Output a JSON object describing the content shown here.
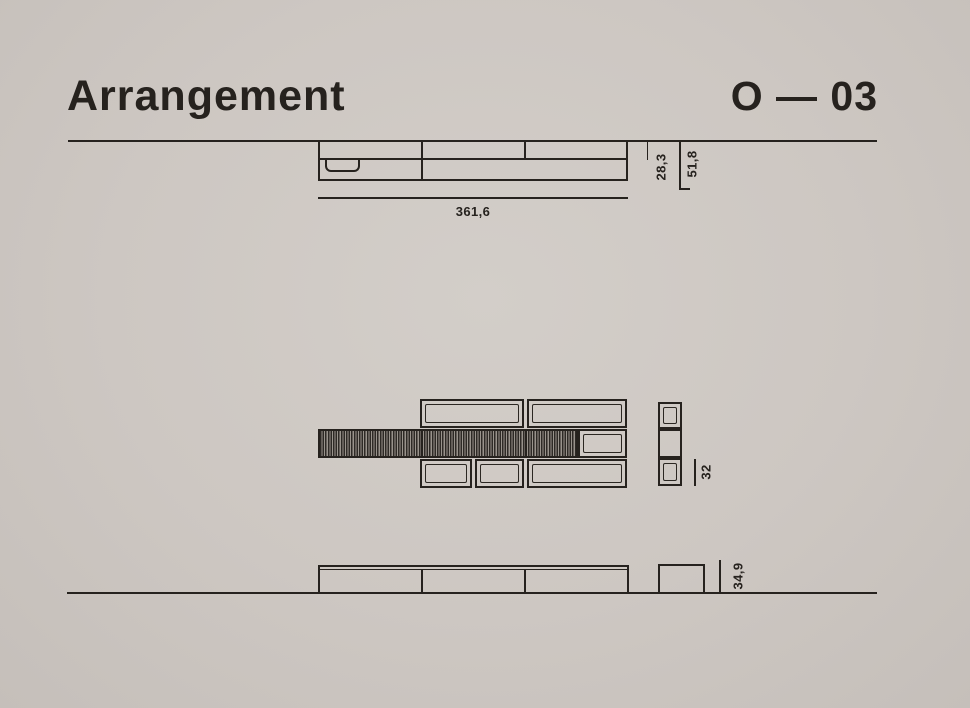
{
  "header": {
    "title": "Arrangement",
    "code": "O — 03"
  },
  "drawing": {
    "top_view": {
      "width": "361,6",
      "front_depth": "28,3",
      "total_depth": "51,8"
    },
    "front_view": {
      "module_height": "32"
    },
    "bottom_view": {
      "unit_height": "34,9"
    }
  },
  "colors": {
    "background": "#cdc7c2",
    "ink": "#26221e",
    "hatch_light": "#99938c"
  },
  "icons": []
}
